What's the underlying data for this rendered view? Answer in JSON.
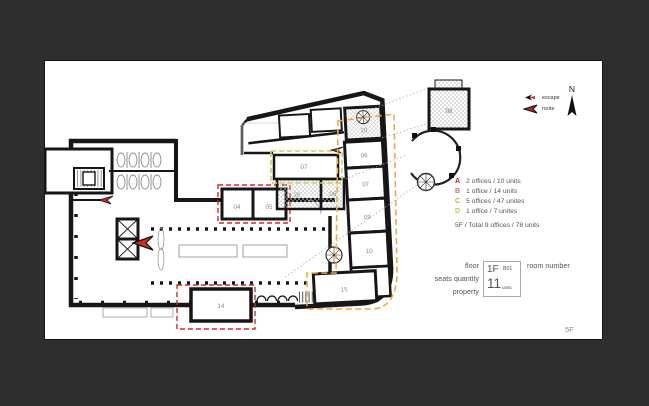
{
  "compass": {
    "n": "N"
  },
  "symbols": {
    "escape": "escape",
    "route": "route"
  },
  "legend": {
    "items": [
      {
        "letter": "A",
        "color": "#c9201c",
        "text": "2 offices / 10 units"
      },
      {
        "letter": "B",
        "color": "#d96a5f",
        "text": "1 office / 14 units"
      },
      {
        "letter": "C",
        "color": "#d9a226",
        "text": "5 offices  / 47 unites"
      },
      {
        "letter": "D",
        "color": "#b9c93f",
        "text": "1 office  / 7 unites"
      }
    ],
    "total": "5F / Total  9 offices  / 78 units"
  },
  "room_key": {
    "floor_label": "floor",
    "seats_label": "seats quantity",
    "property_label": "property",
    "room_number_label": "room number",
    "sample_floor": "1F",
    "sample_room": "B01",
    "sample_seats": "11",
    "sample_units": "units"
  },
  "sheet": {
    "floor": "5F"
  },
  "plan": {
    "rooms": [
      "04",
      "05",
      "07",
      "20",
      "06",
      "06",
      "07",
      "09",
      "10",
      "10",
      "14",
      "15",
      "08"
    ]
  },
  "colors": {
    "zone_a_red": "#d8281e",
    "zone_c_orange": "#f0a73c",
    "zone_d_yellow_green": "#cbd455"
  }
}
